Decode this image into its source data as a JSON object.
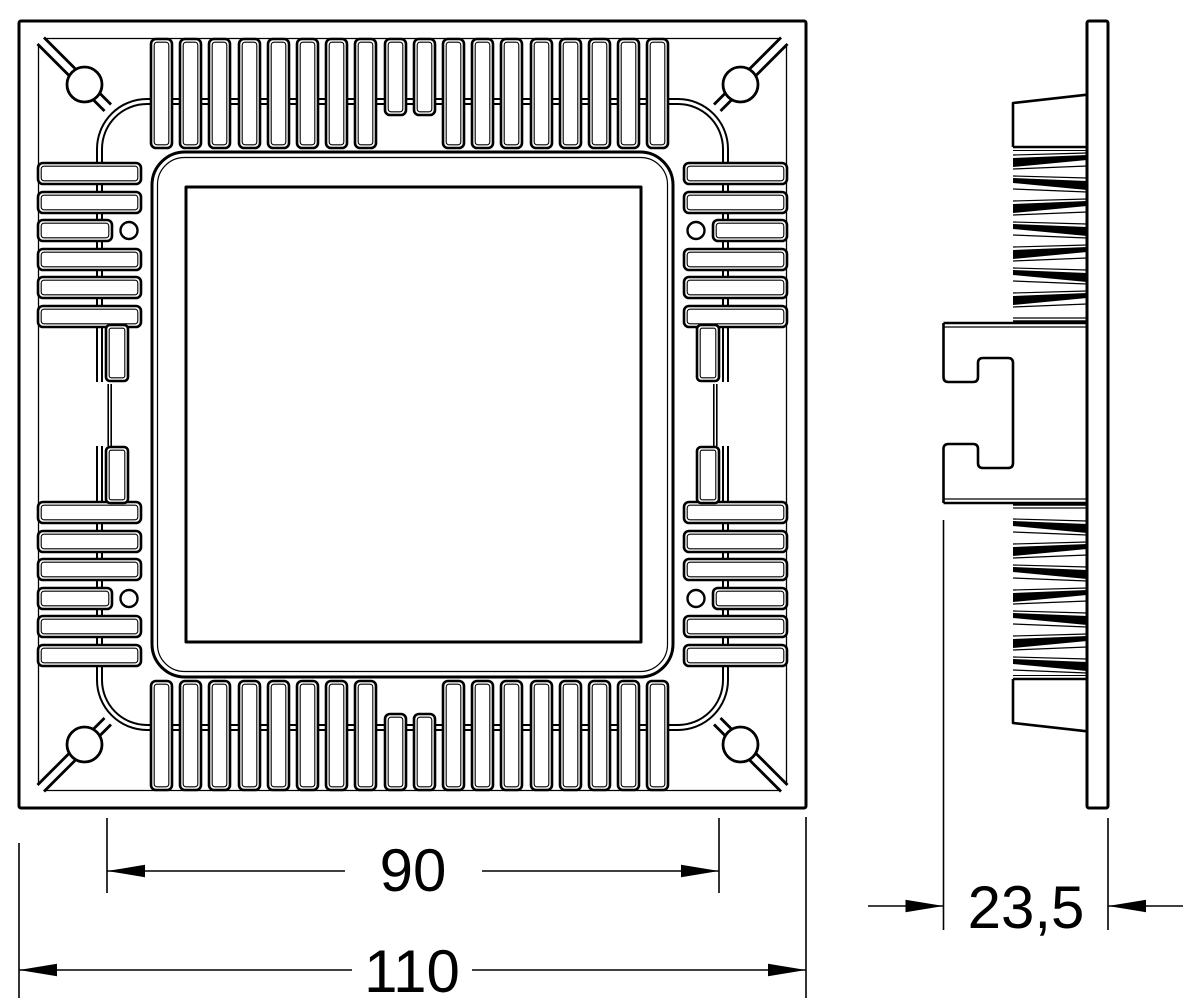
{
  "colors": {
    "background": "#ffffff",
    "line": "#000000"
  },
  "dimensions": {
    "cutout": {
      "value": "90"
    },
    "overall": {
      "value": "110"
    },
    "depth": {
      "value": "23,5"
    }
  }
}
